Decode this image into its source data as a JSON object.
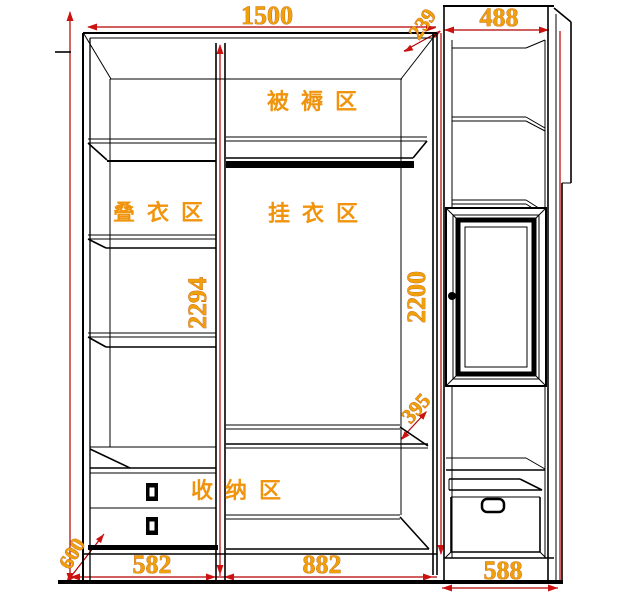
{
  "diagram": {
    "title": "wardrobe-internal-layout-drawing",
    "colors": {
      "background": "#ffffff",
      "outline": "#000000",
      "dimension_line": "#b30000",
      "dimension_arrow": "#cc1111",
      "dimension_text": "#efa00a",
      "zone_text": "#f0940d"
    },
    "zones": {
      "bedding": "被褥区",
      "folding": "叠衣区",
      "hanging": "挂衣区",
      "storage": "收纳区"
    },
    "dimensions": {
      "main_width": "1500",
      "side_width": "488",
      "corner_depth": "239",
      "main_inner_height": "2294",
      "side_inner_height": "2200",
      "shelf_gap": "395",
      "left_bay_width": "582",
      "middle_bay_width": "882",
      "side_bay_width": "588",
      "depth": "600"
    }
  }
}
